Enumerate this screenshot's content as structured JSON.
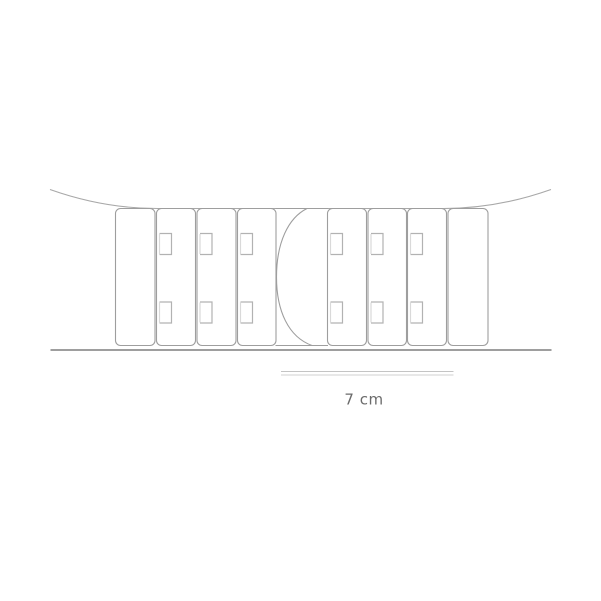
{
  "diagram": {
    "kind": "line-art-illustration",
    "description": "Curved strap draping over a nine-segment extender band with hook holes and a center loop, resting on a ground line, with a size scale below",
    "measurement": {
      "label": "7 cm"
    },
    "colors": {
      "background": "#ffffff",
      "outline": "#9e9e9e",
      "drape_curve": "#a8a8a8",
      "hole_outline": "#b2b2b2",
      "hole_highlight": "#d9d9d9",
      "ground_line": "#909090",
      "scale_line": "#c4c4c4",
      "label_text": "#6b6b6b"
    },
    "band": {
      "top": 208.5,
      "bottom": 345.5,
      "corner_radius": 5,
      "hole": {
        "offset_x": 3,
        "width": 12,
        "height": 21,
        "top_y": 233.5,
        "bottom_y": 302
      },
      "segments": [
        {
          "type": "plain",
          "x": 115.5,
          "width": 39.5
        },
        {
          "type": "holed",
          "x": 156.5,
          "width": 39
        },
        {
          "type": "holed",
          "x": 197,
          "width": 39
        },
        {
          "type": "holed",
          "x": 237.5,
          "width": 38.5
        },
        {
          "type": "loop",
          "x": 276.5,
          "width": 50
        },
        {
          "type": "holed",
          "x": 327.5,
          "width": 39
        },
        {
          "type": "holed",
          "x": 368,
          "width": 38.5
        },
        {
          "type": "holed",
          "x": 407.5,
          "width": 39
        },
        {
          "type": "plain",
          "x": 448,
          "width": 40
        }
      ]
    }
  }
}
